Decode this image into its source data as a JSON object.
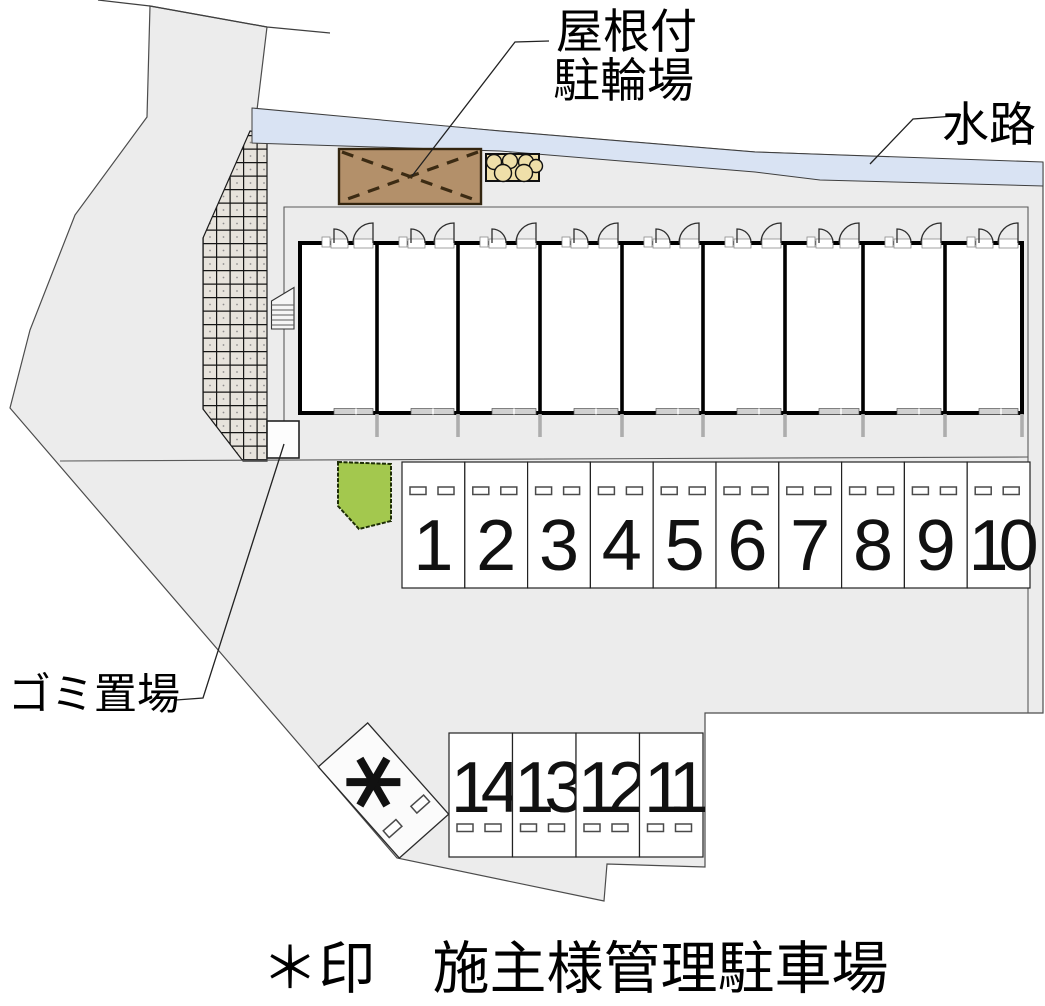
{
  "labels": {
    "bike_shed_line1": "屋根付",
    "bike_shed_line2": "駐輪場",
    "waterway": "水路",
    "garbage": "ゴミ置場",
    "caption": "＊印　施主様管理駐車場",
    "special_space_mark": "＊"
  },
  "parking": {
    "row1_numbers": [
      "1",
      "2",
      "3",
      "4",
      "5",
      "6",
      "7",
      "8",
      "9",
      "10"
    ],
    "row2_numbers": [
      "14",
      "13",
      "12",
      "11"
    ]
  },
  "building": {
    "unit_count": 9
  },
  "colors": {
    "site_fill": "#ececec",
    "waterway_fill": "#d9e3f3",
    "hatch_cell": "#e7e3dc",
    "shed_fill": "#b3906a",
    "planter_fill": "#efdfa9",
    "bush_fill": "#a3c84e",
    "number_color": "#111111"
  }
}
